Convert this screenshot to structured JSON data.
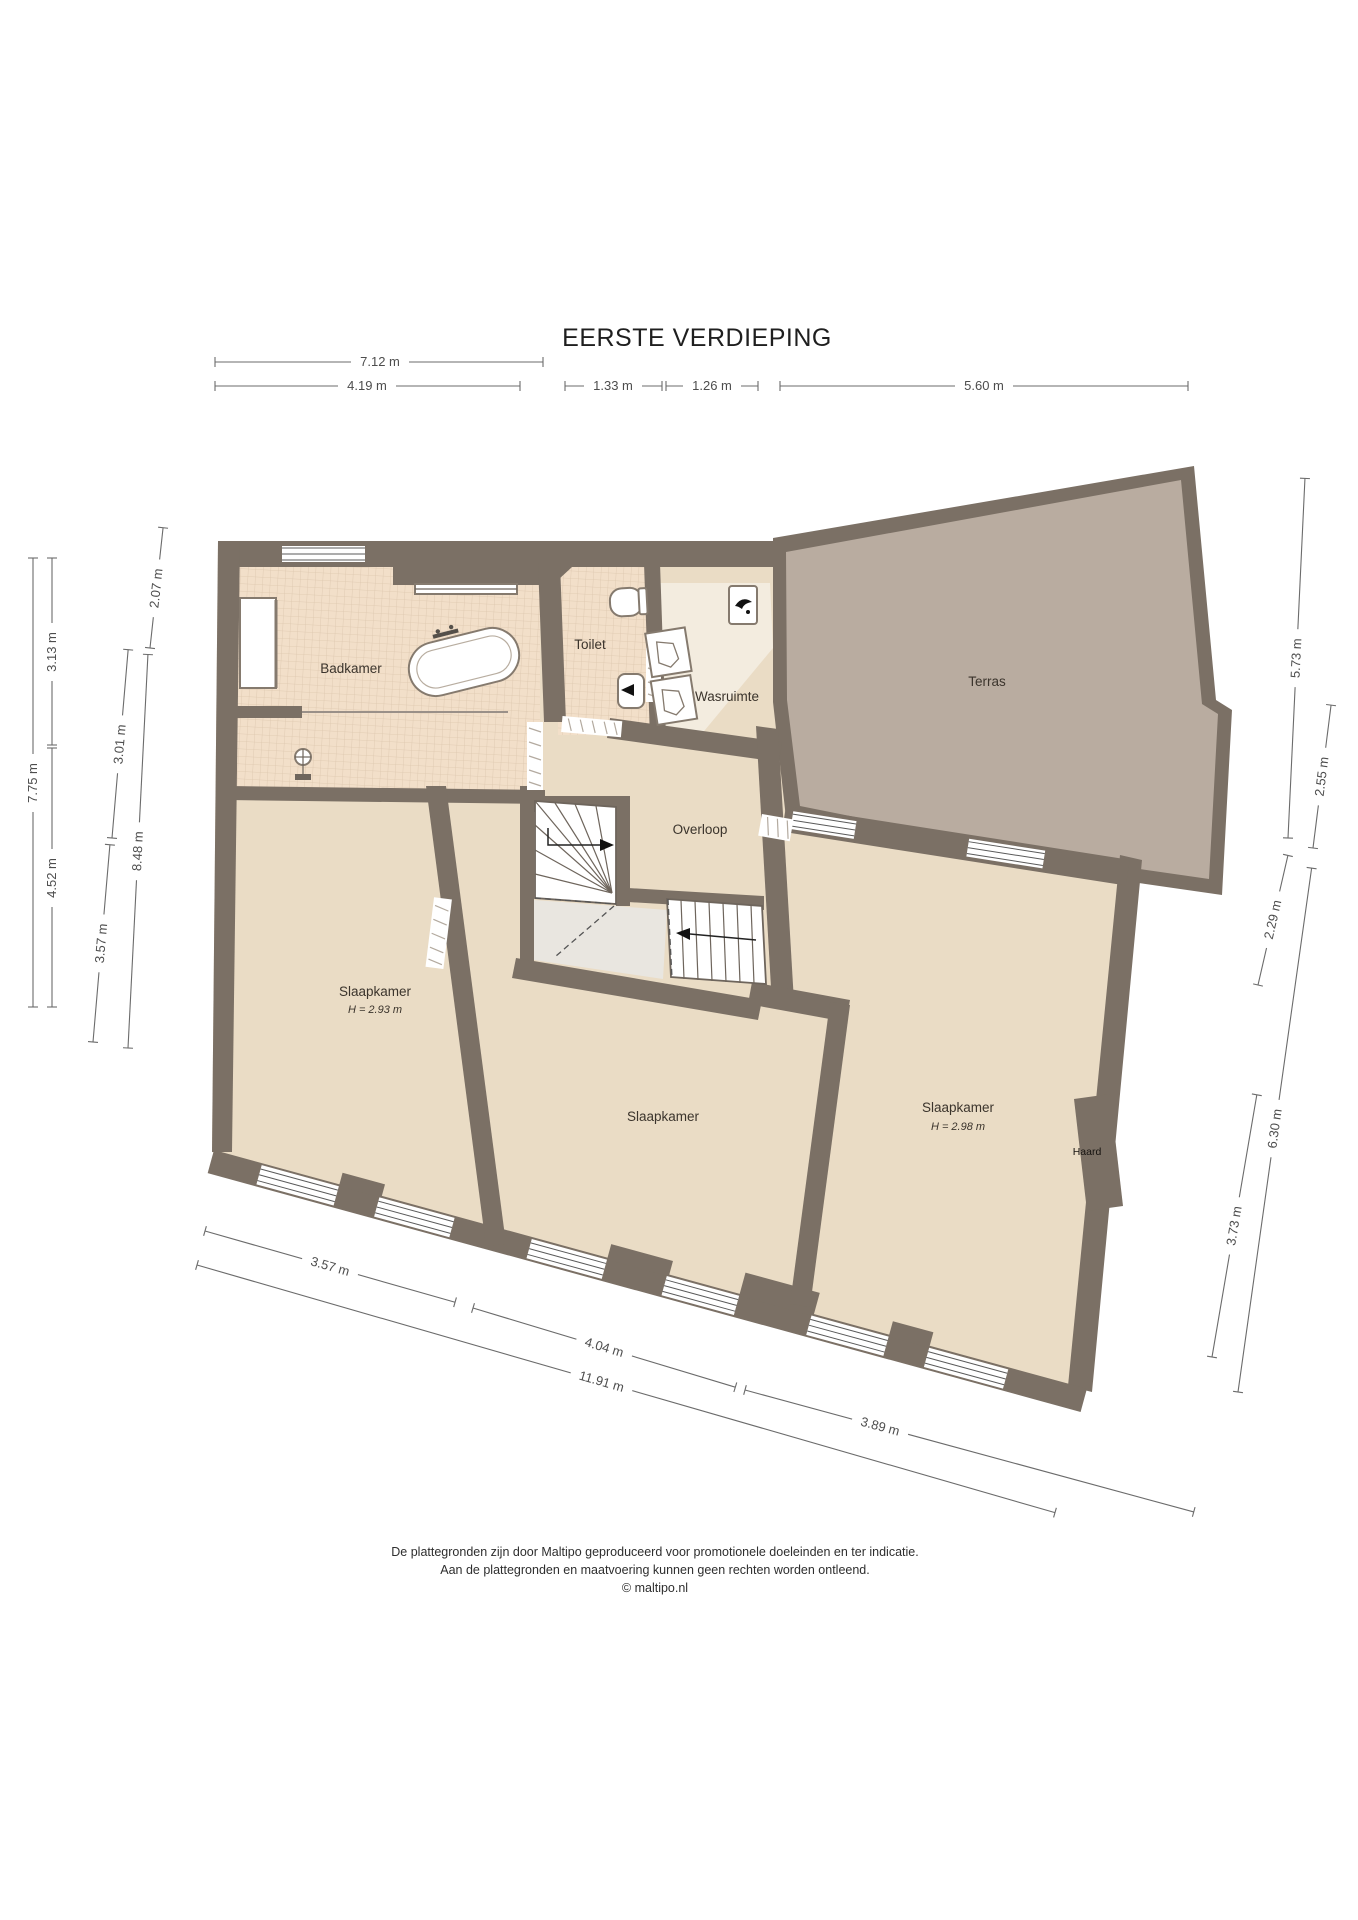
{
  "title": "EERSTE VERDIEPING",
  "rooms": {
    "badkamer": {
      "label": "Badkamer"
    },
    "toilet": {
      "label": "Toilet"
    },
    "wasruimte": {
      "label": "Wasruimte"
    },
    "terras": {
      "label": "Terras"
    },
    "overloop": {
      "label": "Overloop"
    },
    "slaapkamer_links": {
      "label": "Slaapkamer",
      "height": "H = 2.93 m"
    },
    "slaapkamer_midden": {
      "label": "Slaapkamer"
    },
    "slaapkamer_rechts": {
      "label": "Slaapkamer",
      "height": "H = 2.98 m"
    },
    "haard": {
      "label": "Haard"
    }
  },
  "dimensions": {
    "top": [
      "7.12 m",
      "4.19 m",
      "1.33 m",
      "1.26 m",
      "5.60 m"
    ],
    "left": [
      "7.75 m",
      "3.13 m",
      "4.52 m",
      "2.07 m",
      "8.48 m",
      "3.01 m",
      "3.57 m"
    ],
    "right": [
      "5.73 m",
      "2.55 m",
      "2.29 m",
      "6.30 m",
      "3.73 m"
    ],
    "bottom": [
      "3.57 m",
      "4.04 m",
      "11.91 m",
      "3.89 m"
    ]
  },
  "footer": {
    "line1": "De plattegronden zijn door Maltipo geproduceerd voor promotionele doeleinden en ter indicatie.",
    "line2": "Aan de plattegronden en maatvoering kunnen geen rechten worden ontleend.",
    "line3": "© maltipo.nl"
  },
  "colors": {
    "wall": "#7b7065",
    "floor": "#eadcc5",
    "tile": "#f2dfc9",
    "tile_grid": "#dcc6ae",
    "terras": "#b9aca0",
    "utility": "#f3ecdf",
    "landing": "#e9e6e0"
  }
}
